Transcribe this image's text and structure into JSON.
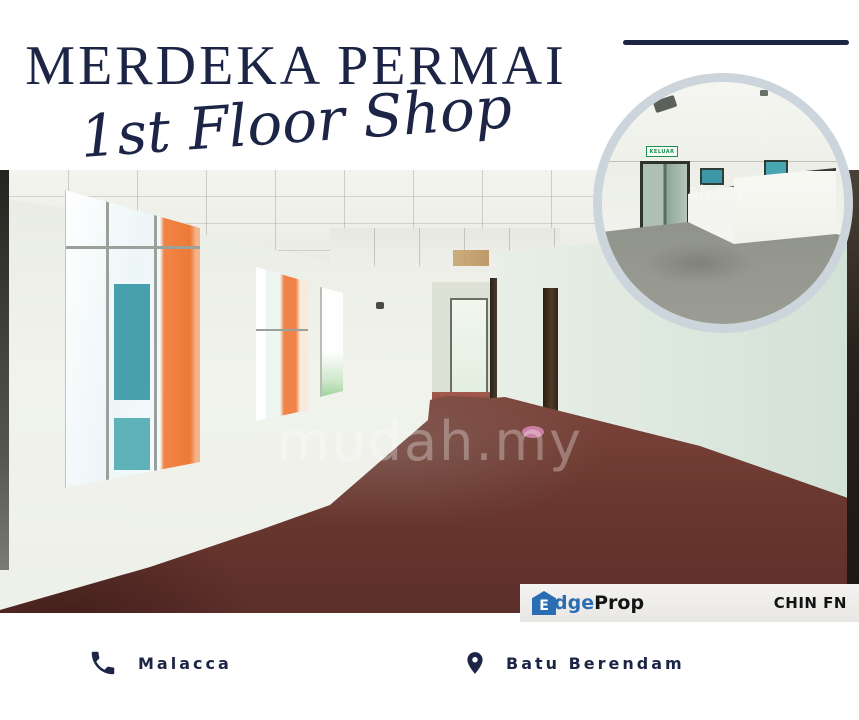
{
  "header": {
    "title": "MERDEKA PERMAI",
    "subtitle": "1st Floor Shop",
    "accent_color": "#1d2546"
  },
  "main_photo": {
    "watermark": "mudah.my",
    "colors": {
      "carpet": "#7e4338",
      "wall": "#eef0ea",
      "ceiling": "#f1f2eb",
      "window_orange": "#ef7d3c",
      "window_teal": "#47a1ad"
    }
  },
  "inset_photo": {
    "shape": "circle",
    "border_color": "#ccd4dc",
    "exit_sign_text": "KELUAR",
    "watermark": "ah.my",
    "colors": {
      "floor": "#90938a",
      "sign_green": "#1d9050"
    }
  },
  "branding_bar": {
    "background": "#efeeec",
    "logo": {
      "icon": "house-icon",
      "house_letter": "E",
      "text_edge": "dge",
      "text_prop": "Prop",
      "blue": "#2a6db3",
      "dark": "#151515"
    },
    "agent_name": "CHIN FN"
  },
  "footer": {
    "items": [
      {
        "icon": "phone-icon",
        "label": "Malacca"
      },
      {
        "icon": "location-pin-icon",
        "label": "Batu Berendam"
      }
    ],
    "text_color": "#1d2546"
  }
}
